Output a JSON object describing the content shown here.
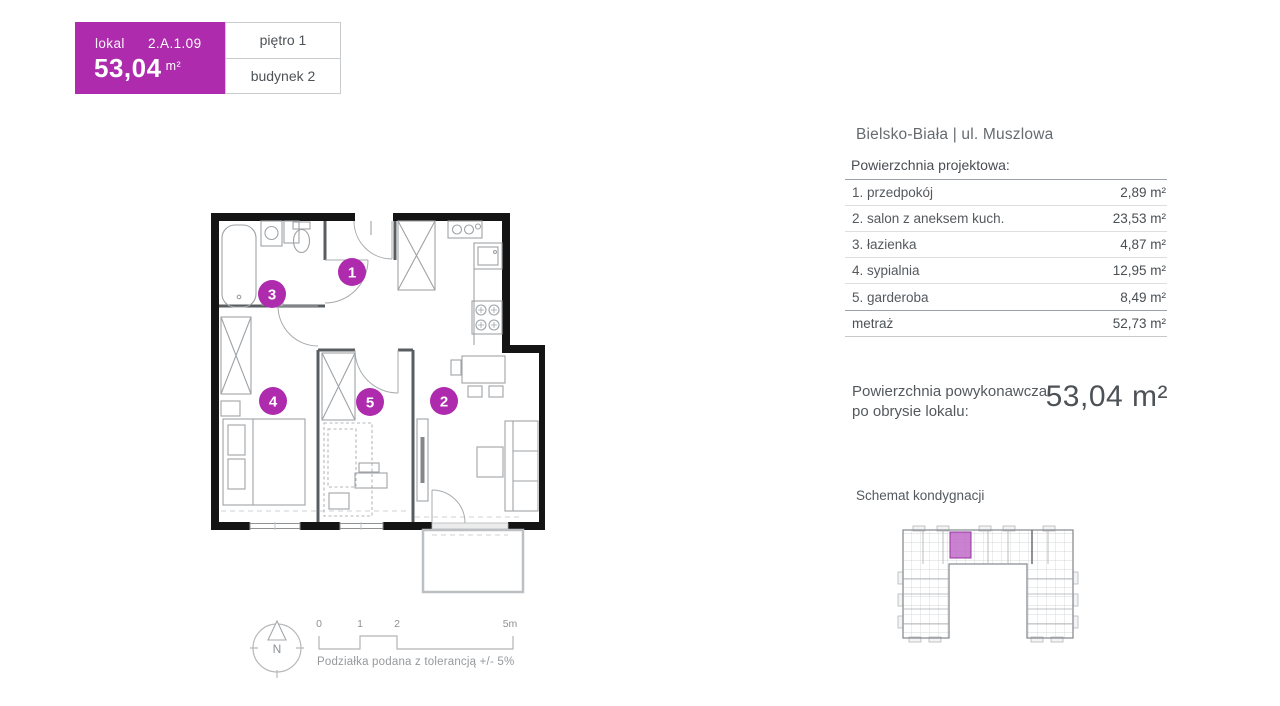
{
  "unit_card": {
    "lokal_label": "lokal",
    "unit_number": "2.A.1.09",
    "area_value": "53,04",
    "area_unit": "m²",
    "floor_label": "piętro 1",
    "building_label": "budynek 2"
  },
  "location_title": "Bielsko-Biała | ul. Muszlowa",
  "area_table": {
    "header": "Powierzchnia projektowa:",
    "rows": [
      {
        "label": "1. przedpokój",
        "value": "2,89 m²"
      },
      {
        "label": "2. salon z aneksem kuch.",
        "value": "23,53 m²"
      },
      {
        "label": "3. łazienka",
        "value": "4,87 m²"
      },
      {
        "label": "4. sypialnia",
        "value": "12,95 m²"
      },
      {
        "label": "5. garderoba",
        "value": "8,49 m²"
      }
    ],
    "total_label": "metraż",
    "total_value": "52,73 m²"
  },
  "as_built": {
    "line1": "Powierzchnia powykonawcza",
    "line2": "po obrysie lokalu:",
    "value": "53,04 m²"
  },
  "floor_schematic_title": "Schemat kondygnacji",
  "floor_plan": {
    "markers": [
      {
        "number": "1"
      },
      {
        "number": "2"
      },
      {
        "number": "3"
      },
      {
        "number": "4"
      },
      {
        "number": "5"
      }
    ]
  },
  "compass": {
    "north_label": "N"
  },
  "scale_bar": {
    "ticks": [
      "0",
      "1",
      "2",
      "5m"
    ],
    "tolerance_note": "Podziałka podana z tolerancją +/- 5%"
  },
  "colors": {
    "accent_purple": "#AD2BAC",
    "schematic_unit_purple": "#C06BC8",
    "wall_black": "#141414",
    "text_dark": "#4d5257",
    "line_light": "#dcdfe1",
    "line_dark": "#9ba1a6"
  }
}
